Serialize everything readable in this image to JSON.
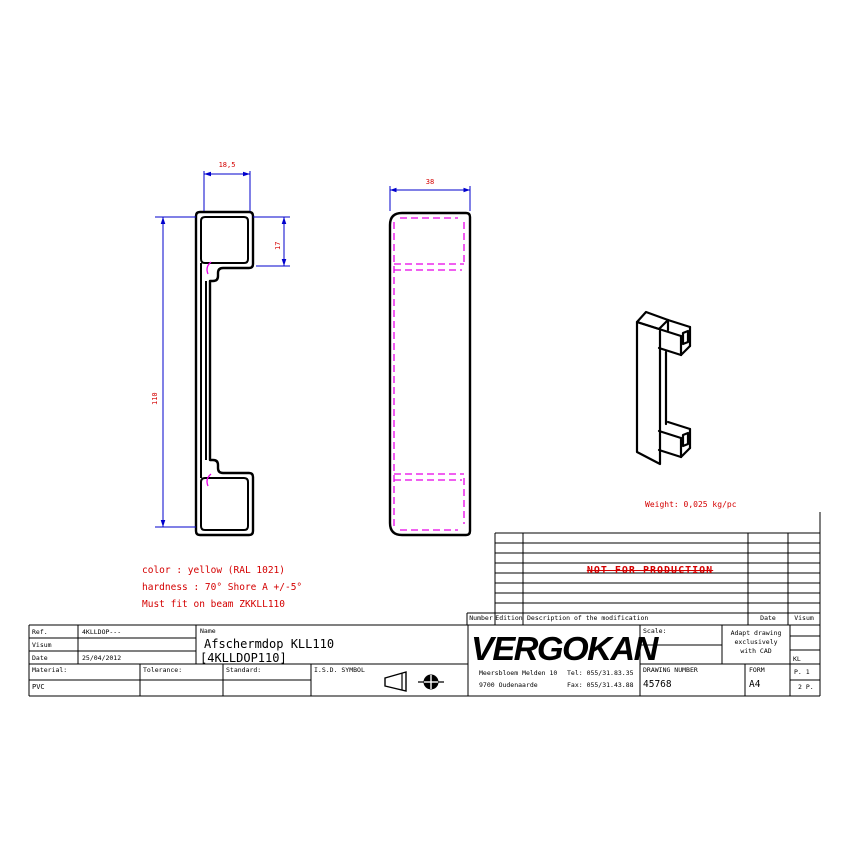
{
  "colors": {
    "dim_blue": "#0000cd",
    "note_red": "#d40000",
    "hidden_magenta": "#e800e8"
  },
  "dimensions": {
    "top_width": "18,5",
    "hook_height": "17",
    "overall_height": "110",
    "front_width": "38"
  },
  "notes": {
    "color": "color : yellow (RAL 1021)",
    "hardness": "hardness : 70° Shore A +/-5°",
    "fit": "Must fit on beam ZKKLL110",
    "weight": "Weight: 0,025 kg/pc",
    "watermark": "NOT FOR PRODUCTION"
  },
  "revision_table": {
    "headers": {
      "number": "Number",
      "edition": "Edition",
      "description": "Description of the modification",
      "date": "Date",
      "visum": "Visum"
    }
  },
  "title_block": {
    "ref_label": "Ref.",
    "ref_value": "4KLLDOP---",
    "visum_label": "Visum",
    "visum_value": "",
    "date_label": "Date",
    "date_value": "25/04/2012",
    "name_label": "Name",
    "name_value": "Afschermdop KLL110",
    "name_code": "[4KLLDOP110]",
    "material_label": "Material:",
    "material_value": "PVC",
    "tolerance_label": "Tolerance:",
    "tolerance_value": "",
    "standard_label": "Standard:",
    "standard_value": "",
    "isd_label": "I.S.D. SYMBOL",
    "company": {
      "logo": "VERGOKAN",
      "address1": "Meersbloem Melden 10",
      "address2": "9700 Oudenaarde",
      "tel": "Tel: 055/31.83.35",
      "fax": "Fax: 055/31.43.88"
    },
    "scale_label": "Scale:",
    "scale_value": "",
    "cad_note_1": "Adapt drawing",
    "cad_note_2": "exclusively",
    "cad_note_3": "with CAD",
    "kl": "KL",
    "drawing_number_label": "DRAWING NUMBER",
    "drawing_number": "45768",
    "form_label": "FORM",
    "form_value": "A4",
    "page": "P. 1",
    "pages": "2 P."
  }
}
